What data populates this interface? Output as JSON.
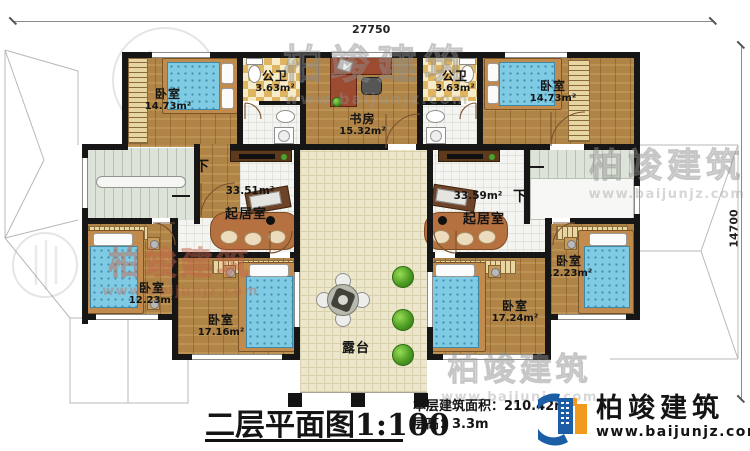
{
  "dimensions": {
    "top": "27750",
    "right": "14700"
  },
  "rooms": {
    "bedroom_tl": {
      "name": "卧室",
      "area": "14.73m²"
    },
    "bath_left": {
      "name": "公卫",
      "area": "3.63m²"
    },
    "study": {
      "name": "书房",
      "area": "15.32m²"
    },
    "bath_right": {
      "name": "公卫",
      "area": "3.63m²"
    },
    "bedroom_tr": {
      "name": "卧室",
      "area": "14.73m²"
    },
    "living_left": {
      "name": "起居室",
      "area": "33.51m²"
    },
    "living_right": {
      "name": "起居室",
      "area": "33.59m²"
    },
    "bedroom_bl": {
      "name": "卧室",
      "area": "12.23m²"
    },
    "bedroom_bml": {
      "name": "卧室",
      "area": "17.16m²"
    },
    "bedroom_bmr": {
      "name": "卧室",
      "area": "17.24m²"
    },
    "bedroom_br": {
      "name": "卧室",
      "area": "12.23m²"
    },
    "terrace": {
      "name": "露台"
    }
  },
  "stairs": {
    "down_label": "下"
  },
  "title_block": {
    "title": "二层平面图",
    "scale": "1:100",
    "area_label": "本层建筑面积：",
    "area_value": "210.42m²",
    "height_label": "层高：",
    "height_value": "3.3m"
  },
  "logo": {
    "company": "柏竣建筑",
    "website": "www.baijunjz.com"
  },
  "watermark": {
    "text": "柏竣建筑",
    "site": "www.baijunjz.com"
  },
  "colors": {
    "wall": "#161616",
    "wood": "#b08446",
    "bed": "#7fcbe4",
    "terrace": "#ebe6cc",
    "logo_blue": "#1b5ea6",
    "logo_orange": "#f29a1e"
  }
}
